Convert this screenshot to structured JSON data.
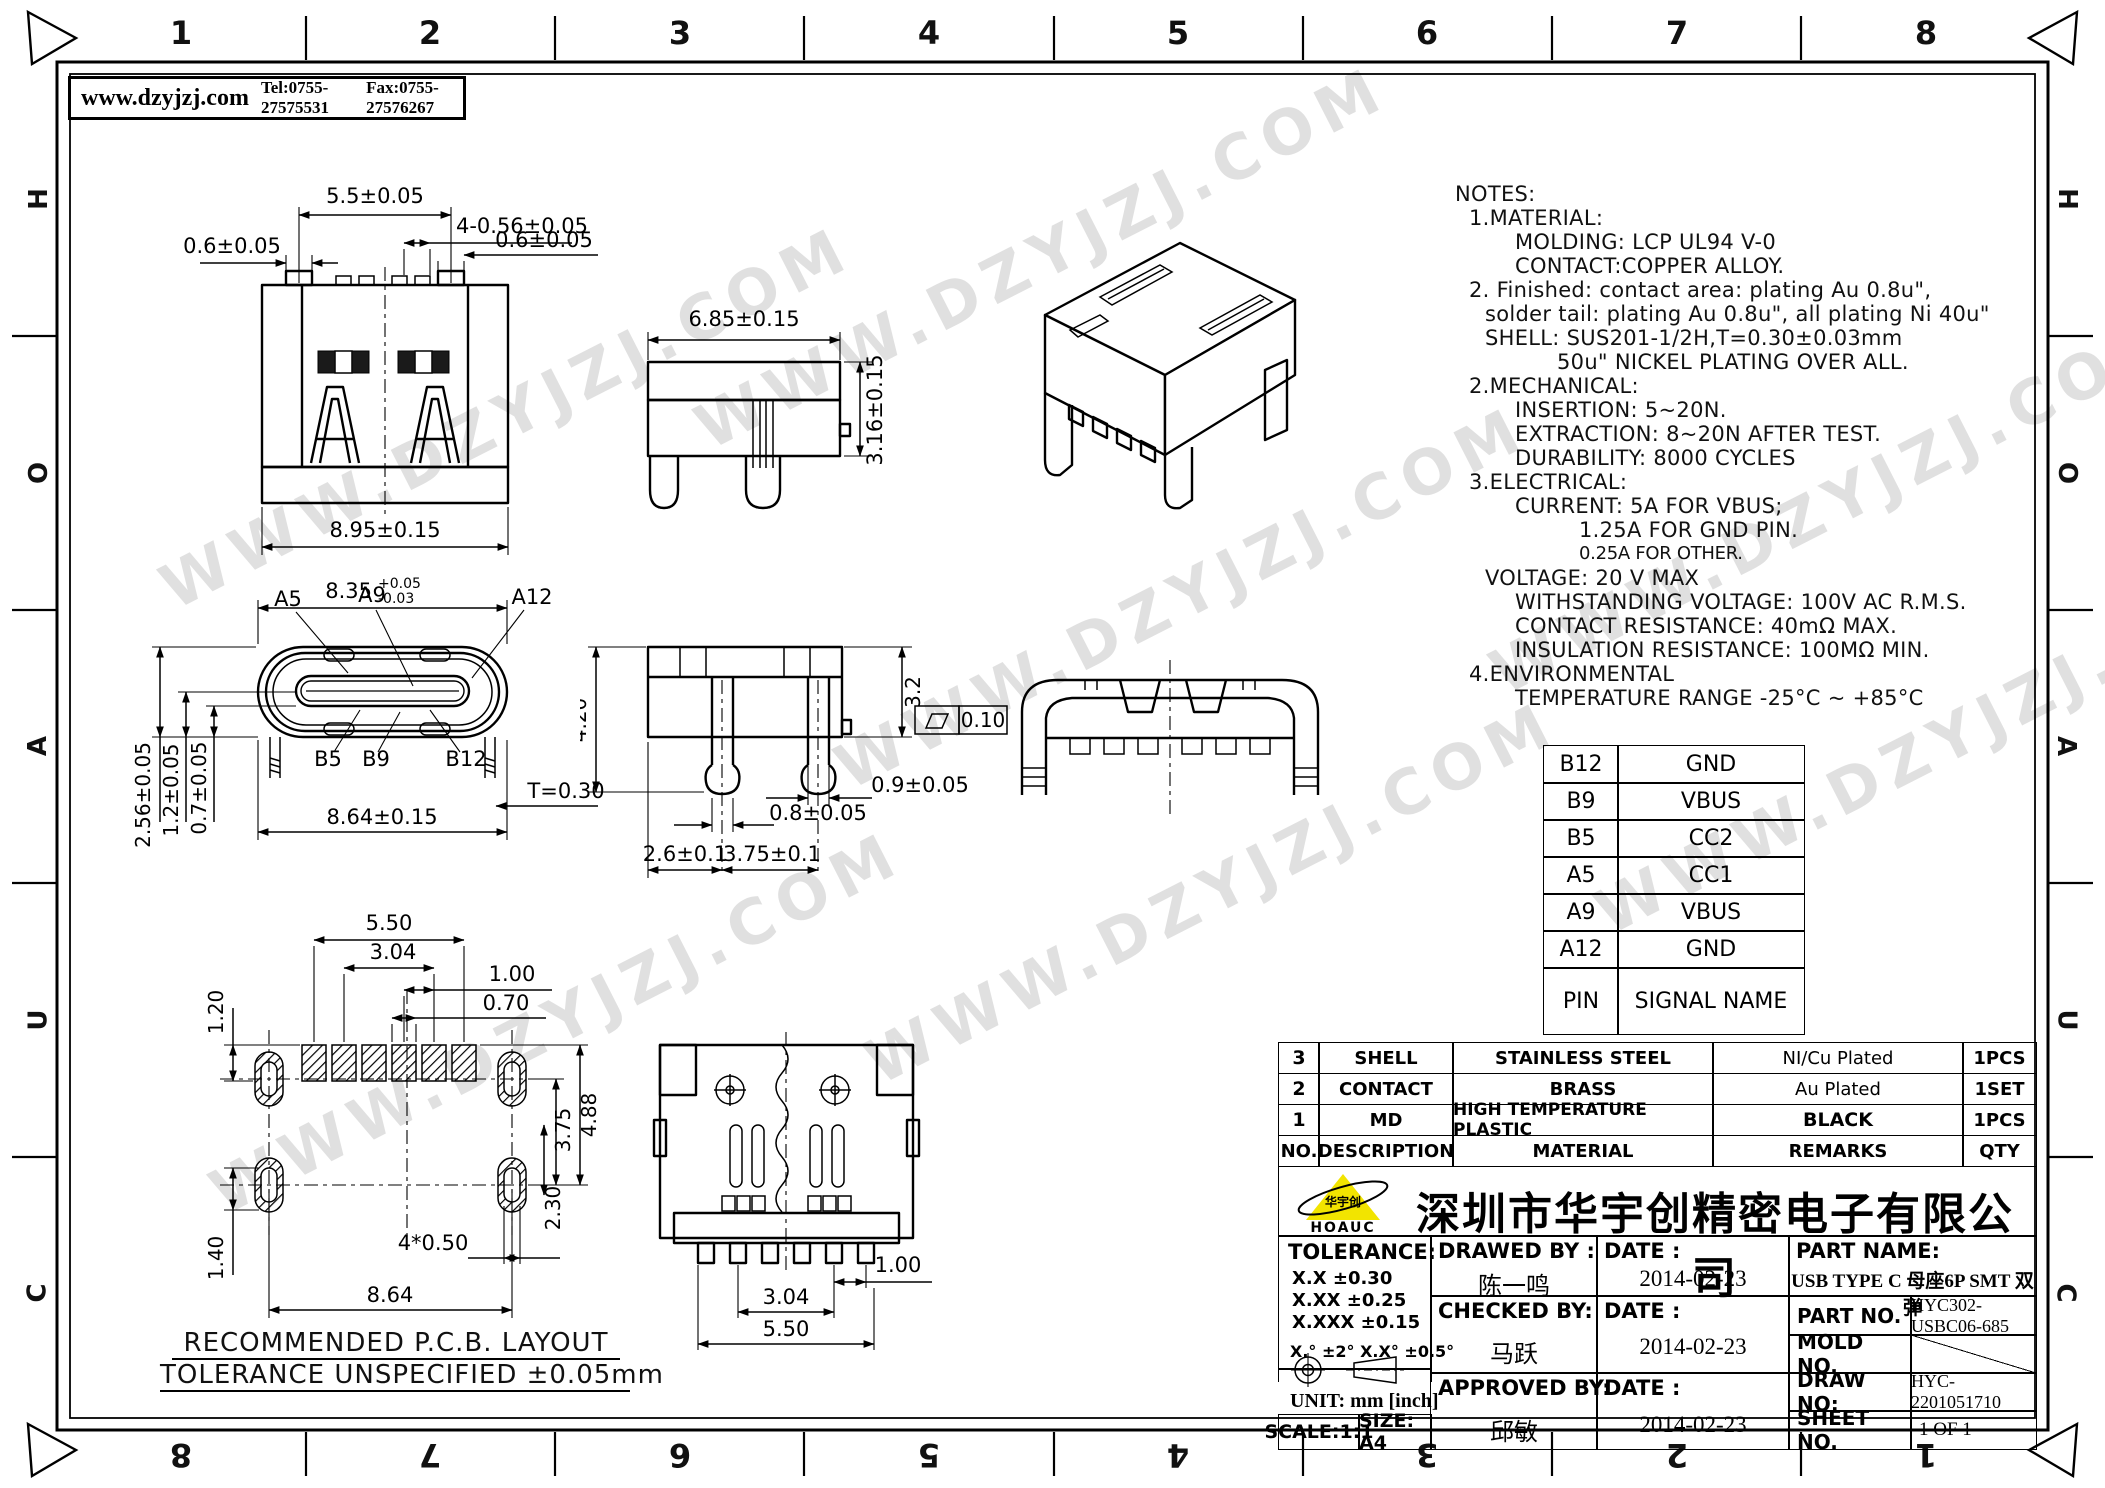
{
  "header": {
    "website": "www.dzyjzj.com",
    "tel": "Tel:0755-27575531",
    "fax": "Fax:0755-27576267"
  },
  "frame": {
    "top_numbers": [
      "1",
      "2",
      "3",
      "4",
      "5",
      "6",
      "7",
      "8"
    ],
    "bottom_numbers": [
      "8",
      "7",
      "6",
      "5",
      "4",
      "3",
      "2",
      "1"
    ],
    "left_letters": [
      "H",
      "O",
      "A",
      "U",
      "C"
    ],
    "right_letters": [
      "H",
      "O",
      "A",
      "U",
      "C"
    ]
  },
  "watermark": {
    "text": "WWW.DZYJZJ.COM"
  },
  "notes": {
    "l0": "NOTES:",
    "l1": "1.MATERIAL:",
    "l2": "MOLDING: LCP UL94 V-0",
    "l3": "CONTACT:COPPER ALLOY.",
    "l4": "2. Finished: contact area: plating Au 0.8u\",",
    "l5": "solder tail: plating Au 0.8u\", all plating Ni 40u\"",
    "l6": "SHELL: SUS201-1/2H,T=0.30±0.03mm",
    "l7": "50u\" NICKEL PLATING OVER ALL.",
    "l8": "2.MECHANICAL:",
    "l9": "INSERTION: 5~20N.",
    "l10": "EXTRACTION: 8~20N AFTER TEST.",
    "l11": "DURABILITY: 8000 CYCLES",
    "l12": "3.ELECTRICAL:",
    "l13": "CURRENT: 5A FOR VBUS;",
    "l14": "1.25A FOR GND PIN.",
    "l15": "0.25A FOR OTHER.",
    "l16": "VOLTAGE: 20 V MAX",
    "l17": "WITHSTANDING VOLTAGE: 100V AC R.M.S.",
    "l18": "CONTACT RESISTANCE: 40mΩ MAX.",
    "l19": "INSULATION RESISTANCE: 100MΩ MIN.",
    "l20": "4.ENVIRONMENTAL",
    "l21": "TEMPERATURE RANGE -25°C ~ +85°C"
  },
  "views": {
    "rear": {
      "d_top": "5.5±0.05",
      "d_group": "4-0.56±0.05",
      "d_left": "0.6±0.05",
      "d_right": "0.6±0.05",
      "d_width": "8.95±0.15"
    },
    "side": {
      "d_width": "6.85±0.15",
      "d_height": "3.16±0.15"
    },
    "front": {
      "p_a5": "A5",
      "p_a9": "A9",
      "p_a12": "A12",
      "p_b5": "B5",
      "p_b9": "B9",
      "p_b12": "B12",
      "d_top": "8.35",
      "d_top_p": "+0.05",
      "d_top_m": "-0.03",
      "d_h1": "2.56±0.05",
      "d_h2": "1.2±0.05",
      "d_h3": "0.7±0.05",
      "d_width": "8.64±0.15",
      "d_t": "T=0.30"
    },
    "pins": {
      "d_height": "4.20",
      "d_body": "3.2",
      "d_flat": "0.10",
      "d_pin2": "0.9±0.05",
      "d_pin1": "0.8±0.05",
      "d_sp1": "2.6±0.1",
      "d_sp2": "3.75±0.1"
    },
    "pcb": {
      "d1": "5.50",
      "d2": "3.04",
      "d3": "1.00",
      "d4": "0.70",
      "d5": "1.20",
      "d6": "4.88",
      "d7": "3.75",
      "d8": "2.30",
      "d9": "1.40",
      "d10": "4*0.50",
      "d11": "8.64",
      "cap1": "RECOMMENDED    P.C.B.  LAYOUT",
      "cap2": "TOLERANCE  UNSPECIFIED  ±0.05mm"
    },
    "bottom": {
      "d1": "1.00",
      "d2": "3.04",
      "d3": "5.50"
    }
  },
  "pin_table": {
    "rows": [
      [
        "B12",
        "GND"
      ],
      [
        "B9",
        "VBUS"
      ],
      [
        "B5",
        "CC2"
      ],
      [
        "A5",
        "CC1"
      ],
      [
        "A9",
        "VBUS"
      ],
      [
        "A12",
        "GND"
      ]
    ],
    "footer": [
      "PIN",
      "SIGNAL NAME"
    ]
  },
  "bom": {
    "headers": [
      "NO.",
      "DESCRIPTION",
      "MATERIAL",
      "REMARKS",
      "QTY"
    ],
    "rows": [
      [
        "3",
        "SHELL",
        "STAINLESS STEEL",
        "NI/Cu Plated",
        "1PCS"
      ],
      [
        "2",
        "CONTACT",
        "BRASS",
        "Au Plated",
        "1SET"
      ],
      [
        "1",
        "MD",
        "HIGH TEMPERATURE PLASTIC",
        "BLACK",
        "1PCS"
      ]
    ]
  },
  "title_block": {
    "company": "深圳市华宇创精密电子有限公司",
    "logo_text": "HOAUC",
    "logo_cn": "华宇创",
    "tolerance_title": "TOLERANCE:",
    "tol1": "X.X    ±0.30",
    "tol2": "X.XX   ±0.25",
    "tol3": "X.XXX  ±0.15",
    "tol_ang": "X.°  ±2°      X.X°  ±0.5°",
    "unit": "UNIT:  mm  [inch]",
    "scale": "SCALE:1:1",
    "size": "SIZE:  A4",
    "drawed_label": "DRAWED BY :",
    "drawed_name": "陈一鸣",
    "date_label1": "DATE :",
    "date1": "2014-02-23",
    "checked_label": "CHECKED BY:",
    "checked_name": "马跃",
    "date_label2": "DATE :",
    "date2": "2014-02-23",
    "approved_label": "APPROVED BY:",
    "approved_name": "邱敏",
    "date_label3": "DATE :",
    "date3": "2014-02-23",
    "part_name_label": "PART NAME:",
    "part_name": "USB TYPE C 母座6P SMT 双弹",
    "part_no_label": "PART NO.",
    "part_no": "HYC302-USBC06-685",
    "mold_no_label": "MOLD NO.",
    "draw_no_label": "DRAW NO:",
    "draw_no": "HYC-2201051710",
    "sheet_no_label": "SHEET NO.",
    "sheet_no": "1 OF 1"
  }
}
